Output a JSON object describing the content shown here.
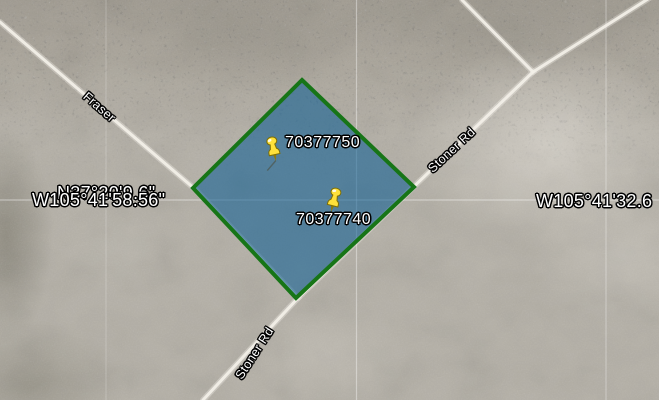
{
  "pins": [
    {
      "label": "70377750"
    },
    {
      "label": "70377740"
    }
  ],
  "roads": [
    {
      "label": "Fraser"
    },
    {
      "label": "Stoner Rd"
    },
    {
      "label": "Stoner Rd"
    }
  ],
  "graticule": {
    "latitude_label": "N37°20'9.6\"",
    "longitude_label_left": "W105°41'58.56\"",
    "longitude_label_right": "W105°41'32.6"
  },
  "colors": {
    "parcel_fill": "rgba(5,90,145,0.55)",
    "parcel_border": "#177517",
    "pushpin": "#FFE13A",
    "road": "#F3F0E8",
    "label_text": "#FFFFFF",
    "label_outline": "#000000"
  }
}
